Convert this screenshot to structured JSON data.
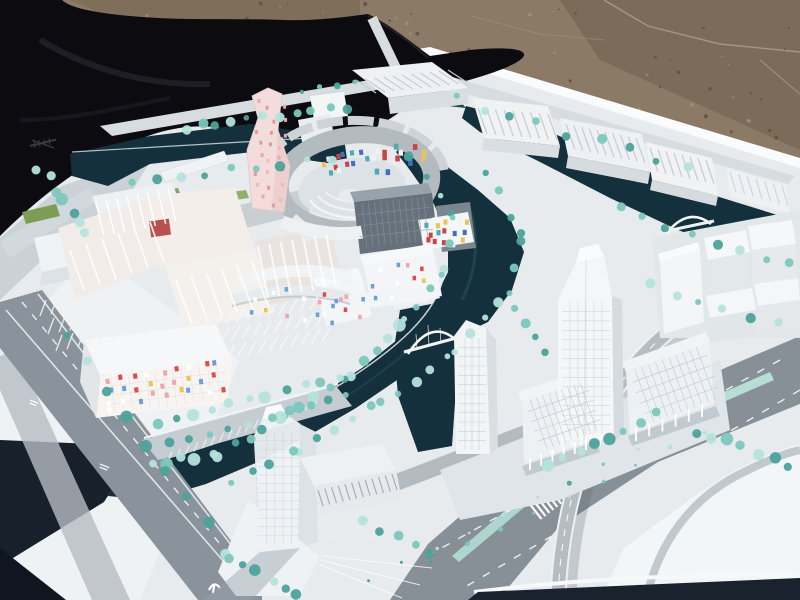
{
  "image": {
    "kind": "outdoor photograph",
    "subject": "architectural scale model of a waterfront urban masterplan, displayed outdoors on a white baseboard between a black tarp and gravel ground",
    "width_px": 800,
    "height_px": 600
  },
  "palette": {
    "gravel": "#8a7a66",
    "gravel_dark": "#6f6050",
    "gravel_light": "#a5947e",
    "tarp": "#0c0c10",
    "tarp_fold": "#26262e",
    "base_white": "#e7ebee",
    "base_bright": "#fafbfc",
    "base_sunlit": "#f2f5f6",
    "deep_shadow": "#18202c",
    "soft_shadow": "#aeb9c2",
    "road": "#8a939b",
    "road_light": "#b5bcc2",
    "road_pale": "#d6dcdf",
    "lane_white": "#ffffff",
    "water": "#14303c",
    "water_light": "#2a5562",
    "tree_mid": "#7cc7bd",
    "tree_dark": "#4da29a",
    "tree_light": "#b5e3dc",
    "building_white": "#f4f5f6",
    "building_shade": "#d9dee2",
    "building_dark": "#c3c9cd",
    "glass_dark": "#67717b",
    "roof_gray": "#b4bbc0",
    "cream": "#f1ece7",
    "red_accent": "#b85050",
    "pink_tower": "#f2dcdc",
    "green_lawn": "#84a35b",
    "median_teal": "#b7ddd5"
  },
  "scene": {
    "background": [
      {
        "name": "black-tarp",
        "desc": "crumpled black tarpaulin, upper left"
      },
      {
        "name": "gravel-ground",
        "desc": "brown gravel pavement with cracks, upper right"
      }
    ],
    "model_features": [
      {
        "name": "pink-tower",
        "desc": "angular high-rise with pink square windows"
      },
      {
        "name": "circular-courtyard-building",
        "desc": "ring building with amphitheater court and colorful mosaic facade"
      },
      {
        "name": "mosaic-facade-building",
        "desc": "low block with confetti-colored windows"
      },
      {
        "name": "canal-network",
        "desc": "dark teal water channels with arch bridges"
      },
      {
        "name": "office-towers",
        "desc": "white gridded towers and slab blocks on pilotis"
      },
      {
        "name": "flyover-ramp",
        "desc": "curved highway ramp, lower right"
      },
      {
        "name": "street-markings",
        "desc": "tiny illegible white road lettering and a rail-transit glyph"
      }
    ]
  },
  "decorations": {
    "tree_colors_keys": [
      "tree_mid",
      "tree_dark",
      "tree_light"
    ],
    "mosaic_sets": {
      "facade": [
        "#d94f4f",
        "#e9c558",
        "#6f9fd8",
        "#eba7b0",
        "#ffffff"
      ],
      "plaza": [
        "#c94545",
        "#3f6fc0",
        "#4fa8b4",
        "#e9c558",
        "#f2f2f2"
      ],
      "pink": [
        "#e39a9a",
        "#eaa8a8",
        "#f0baba"
      ]
    },
    "speckle_fields": [
      [
        70,
        2,
        360,
        34,
        22
      ],
      [
        450,
        5,
        340,
        135,
        40
      ],
      [
        250,
        28,
        180,
        38,
        12
      ]
    ],
    "tree_lines": [
      [
        185,
        128,
        345,
        108,
        11,
        4,
        3
      ],
      [
        132,
        182,
        332,
        158,
        9,
        4,
        3
      ],
      [
        40,
        168,
        88,
        234,
        7,
        5,
        4
      ],
      [
        300,
        92,
        356,
        82,
        4,
        3,
        2
      ],
      [
        452,
        98,
        688,
        170,
        9,
        4,
        5
      ],
      [
        620,
        210,
        788,
        264,
        8,
        4,
        4
      ],
      [
        650,
        284,
        776,
        324,
        6,
        4,
        4
      ],
      [
        410,
        154,
        452,
        214,
        4,
        4,
        3
      ],
      [
        450,
        220,
        446,
        270,
        3,
        4,
        3
      ],
      [
        442,
        276,
        406,
        320,
        4,
        4,
        3
      ],
      [
        402,
        326,
        348,
        374,
        5,
        5,
        3
      ],
      [
        342,
        378,
        286,
        416,
        5,
        5,
        3
      ],
      [
        280,
        420,
        218,
        454,
        5,
        5,
        3
      ],
      [
        212,
        456,
        150,
        464,
        5,
        5,
        3
      ],
      [
        488,
        172,
        522,
        236,
        4,
        4,
        3
      ],
      [
        520,
        242,
        508,
        296,
        3,
        4,
        3
      ],
      [
        500,
        302,
        456,
        350,
        4,
        4,
        3
      ],
      [
        448,
        356,
        382,
        404,
        5,
        4,
        3
      ],
      [
        374,
        408,
        300,
        450,
        5,
        4,
        3
      ],
      [
        292,
        454,
        230,
        484,
        4,
        4,
        3
      ],
      [
        158,
        426,
        340,
        376,
        11,
        5,
        3
      ],
      [
        172,
        444,
        348,
        396,
        10,
        4,
        3
      ],
      [
        64,
        334,
        228,
        552,
        9,
        5,
        4
      ],
      [
        230,
        558,
        298,
        592,
        6,
        5,
        4
      ],
      [
        362,
        520,
        430,
        556,
        5,
        5,
        3
      ],
      [
        550,
        464,
        656,
        416,
        8,
        5,
        4
      ],
      [
        696,
        430,
        788,
        464,
        7,
        5,
        4
      ],
      [
        512,
        308,
        546,
        352,
        4,
        4,
        3
      ],
      [
        368,
        580,
        638,
        450,
        9,
        2,
        2
      ],
      [
        432,
        562,
        704,
        432,
        9,
        2,
        2
      ]
    ],
    "mosaic_fields": [
      {
        "x": 320,
        "y": 148,
        "w": 48,
        "h": 26,
        "n": 12,
        "s": 4,
        "set": "plaza",
        "tf": "rotate(-8 344 161)"
      },
      {
        "x": 370,
        "y": 142,
        "w": 54,
        "h": 30,
        "n": 14,
        "s": 4.5,
        "set": "plaza"
      },
      {
        "x": 422,
        "y": 216,
        "w": 46,
        "h": 28,
        "n": 15,
        "s": 4,
        "set": "plaza"
      },
      {
        "x": 368,
        "y": 260,
        "w": 64,
        "h": 40,
        "n": 10,
        "s": 3.5,
        "set": "facade"
      },
      {
        "x": 318,
        "y": 284,
        "w": 46,
        "h": 34,
        "n": 8,
        "s": 3.5,
        "set": "facade"
      },
      {
        "x": 102,
        "y": 364,
        "w": 122,
        "h": 46,
        "n": 28,
        "s": 4,
        "set": "facade",
        "tf": "rotate(-7 163 387)"
      },
      {
        "x": 246,
        "y": 284,
        "w": 92,
        "h": 40,
        "n": 12,
        "s": 3.5,
        "set": "facade"
      },
      {
        "x": 252,
        "y": 96,
        "w": 34,
        "h": 110,
        "n": 24,
        "s": 3,
        "set": "pink"
      }
    ],
    "window_grids": [
      {
        "x": 458,
        "y": 338,
        "w": 28,
        "h": 112,
        "c": 4,
        "r": 12,
        "col": "#c3ccd2"
      },
      {
        "x": 562,
        "y": 302,
        "w": 48,
        "h": 132,
        "c": 6,
        "r": 14,
        "col": "#c9d1d6"
      },
      {
        "x": 524,
        "y": 402,
        "w": 66,
        "h": 52,
        "c": 10,
        "r": 5,
        "col": "#b9c2c8",
        "tf": "rotate(-19 524 402)"
      },
      {
        "x": 628,
        "y": 372,
        "w": 80,
        "h": 56,
        "c": 11,
        "r": 5,
        "col": "#b9c2c8",
        "tf": "rotate(-20 628 372)"
      },
      {
        "x": 258,
        "y": 432,
        "w": 42,
        "h": 112,
        "c": 5,
        "r": 13,
        "col": "#ccd5da"
      },
      {
        "x": 356,
        "y": 204,
        "w": 74,
        "h": 44,
        "c": 12,
        "r": 4,
        "col": "#8b959e",
        "tf": "rotate(-6 356 204)"
      },
      {
        "x": 102,
        "y": 378,
        "w": 124,
        "h": 36,
        "c": 14,
        "r": 4,
        "col": "#e5e0dc",
        "tf": "rotate(-7 102 378)"
      }
    ],
    "hatch_fields": [
      [
        356,
        80,
        448,
        70,
        11,
        20,
        13,
        1.3,
        "#c7cdd2",
        0.95
      ],
      [
        478,
        108,
        548,
        114,
        9,
        9,
        26,
        1.3,
        "#c7cdd2",
        0.95
      ],
      [
        566,
        124,
        636,
        138,
        10,
        9,
        25,
        1.3,
        "#c7cdd2",
        0.95
      ],
      [
        650,
        148,
        706,
        160,
        8,
        8,
        24,
        1.3,
        "#c7cdd2",
        0.95
      ],
      [
        730,
        172,
        782,
        186,
        7,
        6,
        20,
        1.2,
        "#cdd3d7",
        0.9
      ],
      [
        70,
        250,
        150,
        222,
        6,
        14,
        40,
        1.8,
        "#ffffff",
        0.85
      ],
      [
        176,
        280,
        252,
        262,
        6,
        16,
        44,
        1.8,
        "#ffffff",
        0.85
      ],
      [
        258,
        246,
        326,
        234,
        7,
        10,
        52,
        2,
        "#ffffff",
        0.8
      ],
      [
        96,
        202,
        168,
        188,
        8,
        8,
        34,
        1.6,
        "#ffffff",
        0.9
      ],
      [
        46,
        300,
        134,
        286,
        9,
        -6,
        16,
        1.4,
        "#eef2f4",
        0.9
      ],
      [
        54,
        318,
        142,
        303,
        9,
        -6,
        16,
        1.4,
        "#eef2f4",
        0.9
      ],
      [
        62,
        335,
        150,
        320,
        9,
        -6,
        16,
        1.4,
        "#eef2f4",
        0.9
      ],
      [
        202,
        316,
        318,
        296,
        12,
        -8,
        14,
        1.6,
        "#f4f6f7",
        0.9
      ],
      [
        208,
        332,
        324,
        312,
        12,
        -8,
        14,
        1.6,
        "#f4f6f7",
        0.9
      ],
      [
        214,
        348,
        330,
        328,
        12,
        -8,
        14,
        1.6,
        "#f4f6f7",
        0.9
      ],
      [
        318,
        490,
        392,
        474,
        12,
        5,
        16,
        1.2,
        "#9fa9b0",
        0.9
      ],
      [
        172,
        452,
        318,
        398,
        18,
        -4,
        9,
        1.2,
        "#eef2f4",
        0.85
      ],
      [
        530,
        458,
        586,
        438,
        6,
        0,
        12,
        2,
        "#ffffff",
        0.95
      ],
      [
        636,
        428,
        702,
        404,
        6,
        0,
        13,
        2,
        "#ffffff",
        0.95
      ],
      [
        562,
        436,
        610,
        436,
        6,
        0,
        10,
        1.6,
        "#ffffff",
        0.9
      ]
    ]
  }
}
